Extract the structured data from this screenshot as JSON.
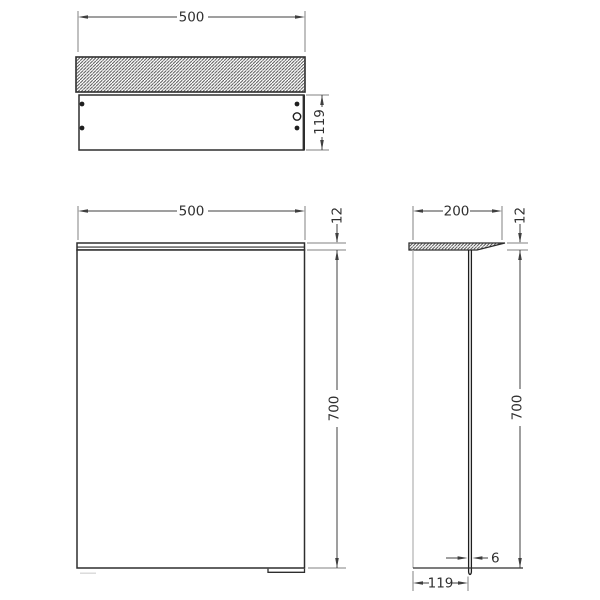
{
  "drawing": {
    "background": "#ffffff",
    "colors": {
      "object_line": "#2e2e2e",
      "dimension_line": "#3f3f3f",
      "extension_line": "#808080",
      "hatch_line": "#4a4a4a",
      "text": "#2f2f2f",
      "mirror_edge_line": "#b0b0b0"
    },
    "views": {
      "top": {
        "dimensions": {
          "width": "500",
          "depth": "119"
        }
      },
      "front": {
        "dimensions": {
          "width": "500",
          "plate_thickness": "12",
          "height": "700"
        }
      },
      "side": {
        "dimensions": {
          "depth": "200",
          "plate_thickness": "12",
          "height": "700",
          "panel_thickness": "6",
          "panel_offset": "119"
        }
      }
    }
  }
}
